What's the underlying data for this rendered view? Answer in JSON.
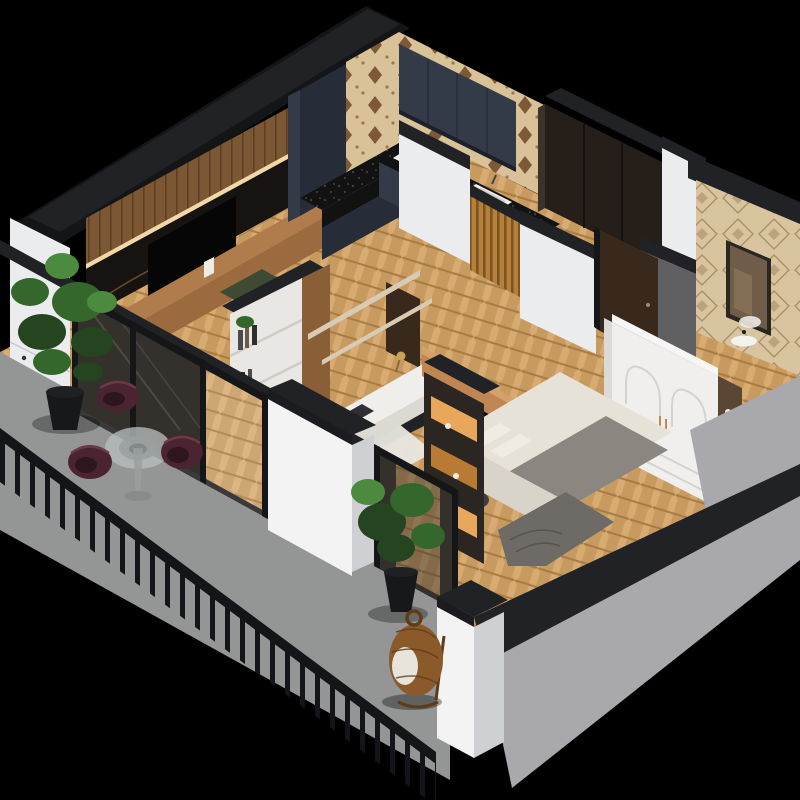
{
  "scene": {
    "title": "3D isometric apartment floor plan cutaway render",
    "rooms": [
      {
        "name": "living-room",
        "furniture": [
          "wood-panel-wall",
          "led-strip",
          "marble-tv-wall",
          "tv",
          "media-console",
          "decor-vase",
          "green-seat"
        ]
      },
      {
        "name": "kitchen",
        "furniture": [
          "tall-cabinet",
          "patterned-backsplash",
          "upper-cabinets",
          "black-countertop",
          "cooktop",
          "sink",
          "base-cabinets"
        ]
      },
      {
        "name": "hallway",
        "furniture": [
          "wood-slat-partition",
          "runner-rug",
          "open-door"
        ]
      },
      {
        "name": "study-nook",
        "furniture": [
          "bookshelf",
          "books",
          "wall-shelves",
          "desk",
          "laptop",
          "desk-lamp"
        ]
      },
      {
        "name": "bedroom",
        "furniture": [
          "tv-console",
          "tv",
          "bed",
          "pillows",
          "blanket",
          "foot-drape",
          "pouf",
          "arched-wardrobe",
          "lit-display-cabinet",
          "side-niche"
        ]
      },
      {
        "name": "bathroom",
        "furniture": [
          "patterned-tile-wall",
          "mirror",
          "basin",
          "vanity-wall"
        ]
      },
      {
        "name": "entry",
        "furniture": [
          "dark-wardrobe"
        ]
      },
      {
        "name": "balcony",
        "furniture": [
          "storage-cabinet",
          "potted-plant-large",
          "round-glass-table",
          "armchair-1",
          "armchair-2",
          "armchair-3",
          "potted-plant-small",
          "hanging-egg-chair",
          "metal-railing"
        ]
      }
    ]
  },
  "colors": {
    "background": "#000000",
    "capBlack": "#202225",
    "capLip": "#1a1c1f",
    "wallDarkSilhouette": "#141517",
    "wallWhite": "#ebecee",
    "wallWhiteBright": "#f3f3f4",
    "wallWhiteShade": "#cfd0d4",
    "wallGrayExterior": "#a8a8ad",
    "grayConcrete": "#606062",
    "floorWood": "#c79a60",
    "floorWoodLight": "#d8ab72",
    "floorWoodDark": "#a87a44",
    "balconyFloor": "#949695",
    "woodPanel": "#7b5733",
    "woodPanelDark": "#5e3f22",
    "ledStrip": "#ffe3b0",
    "marble": "#161310",
    "marbleVein": "#8d6c3e",
    "tv": "#060607",
    "consoleWood": "#9b6a3f",
    "consoleWoodTop": "#b07c4c",
    "navyCabinet": "#333a48",
    "navyCabinetDark": "#262c38",
    "uppersShadow": "#1c212b",
    "counterBlack": "#121212",
    "counterSpeckle": "#3f3f3f",
    "cooktopWhite": "#f2f2f0",
    "burner": "#17181a",
    "sinkWhite": "#f0efec",
    "sinkInner": "#cfcec9",
    "wallpaperBase": "#d9c297",
    "wallpaperMotif": "#6e4625",
    "slatWood": "#b5803c",
    "slatWoodDark": "#7d5420",
    "doorBrown": "#39291c",
    "frameBlack": "#141618",
    "sill": "#3a3a3c",
    "glass": "#34302c",
    "entryWardrobe": "#261f19",
    "entryWardrobeEdge": "#3b332a",
    "tileBeige": "#d8c49f",
    "tileMotif": "#a98e62",
    "mirrorFrame": "#2a2622",
    "mirrorGlass": "#6f5d49",
    "mirrorReflect": "#8a7458",
    "basinWhite": "#f3f2ef",
    "wardrobeWhite": "#f0efed",
    "wardrobeTop": "#f7f6f4",
    "wardrobeLine": "#d5d3cf",
    "wardrobeSide": "#dcdad6",
    "nicheBrown": "#5b4634",
    "handleGold": "#b98e4a",
    "bedSheet": "#e7e2d8",
    "bedBlanket": "#8b8680",
    "bedPillow": "#efece4",
    "bedSide": "#d9d4ca",
    "bedDrape": "#6e6a65",
    "bedConsole": "#c08552",
    "bedConsoleTop": "#d6a06b",
    "pouf": "#3f3f42",
    "shelfGlow": "#e8a75a",
    "shelfGlowDeep": "#b97b33",
    "cabinetFrame": "#2b2622",
    "bookshelfWhite": "#e9e7e3",
    "bookshelfWood": "#8a5f38",
    "shelfLine": "#cfccc6",
    "shelfWood": "#d8cbb4",
    "bookDark": "#2e2e31",
    "bookBrown": "#6b5a48",
    "bookGray": "#4a4a4f",
    "deskWhite": "#efeeea",
    "deskEdge": "#dcd9d3",
    "laptop": "#2e2e33",
    "lampShade": "#c9a25a",
    "rug": "#e9e7e2",
    "railing": "#131518",
    "chairBurgundy": "#4a2531",
    "chairBurgundyDark": "#2e161f",
    "chairBurgundyLight": "#6c3a47",
    "tableGlass": "#b9bdbd",
    "tableInner": "#9aa0a0",
    "tableStem": "#9b9fa0",
    "plantGreenDark": "#24451f",
    "plantGreen": "#35672c",
    "plantGreenLight": "#4c8a3f",
    "potBlack": "#17181a",
    "potRim": "#1f2022",
    "wicker": "#8a5a2b",
    "wickerDark": "#5f3b18",
    "cushionWhite": "#e8e4dc",
    "greenSeat": "#3e4a33"
  }
}
